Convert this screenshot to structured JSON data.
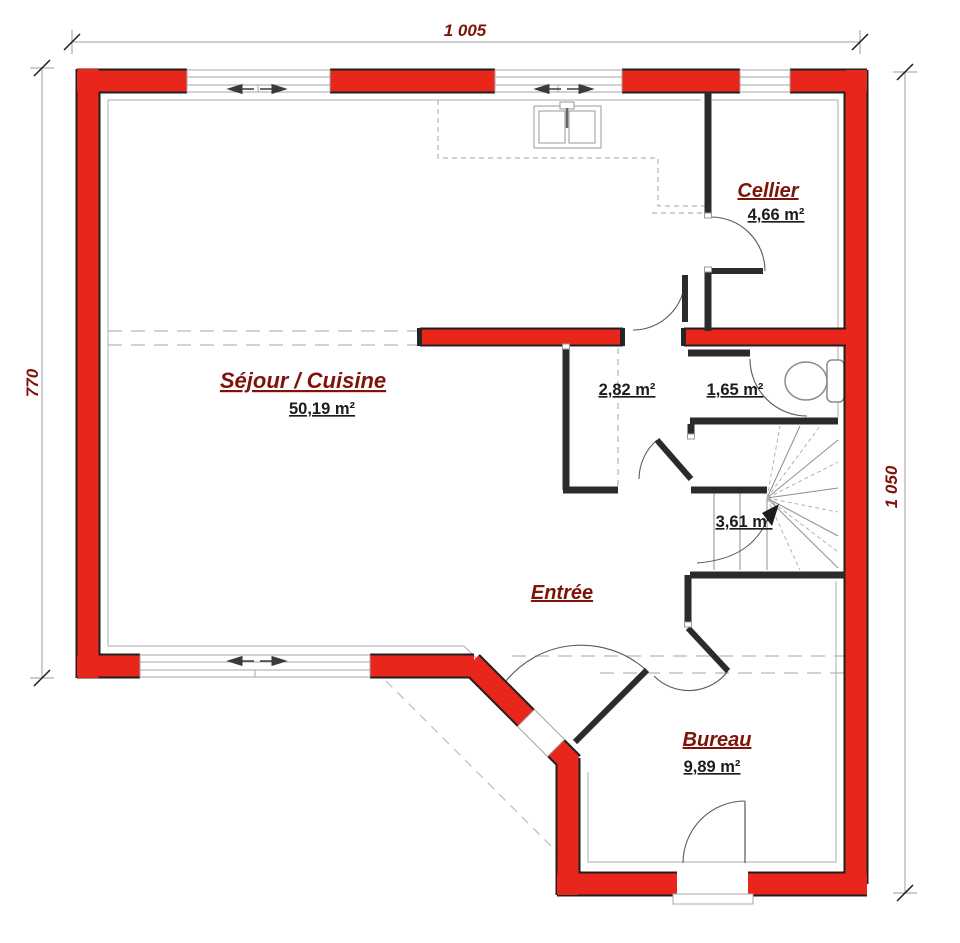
{
  "plan_title": "floor-plan-ground-floor",
  "dimensions": {
    "top": "1 005",
    "left": "770",
    "right": "1 050"
  },
  "rooms": {
    "sejour": {
      "name": "Séjour / Cuisine",
      "area": "50,19 m²"
    },
    "cellier": {
      "name": "Cellier",
      "area": "4,66 m²"
    },
    "closet": {
      "area": "2,82 m²"
    },
    "wc": {
      "area": "1,65 m²"
    },
    "stairs": {
      "area": "3,61 m²"
    },
    "entree": {
      "name": "Entrée"
    },
    "bureau": {
      "name": "Bureau",
      "area": "9,89 m²"
    }
  },
  "icons": {
    "toilet": "toilet-icon",
    "sink": "kitchen-sink-icon",
    "stairs": "winder-stairs-icon",
    "window_arrows": "sliding-window-arrows-icon"
  },
  "colors": {
    "wall_red": "#e8261c",
    "wall_outline": "#1f1f1f",
    "partition_black": "#2b2b2b",
    "label_dark_red": "#7e130a",
    "area_black": "#1c1c1c",
    "thin_line_gray": "#ababab",
    "dashed_gray": "#c4c4c4"
  }
}
